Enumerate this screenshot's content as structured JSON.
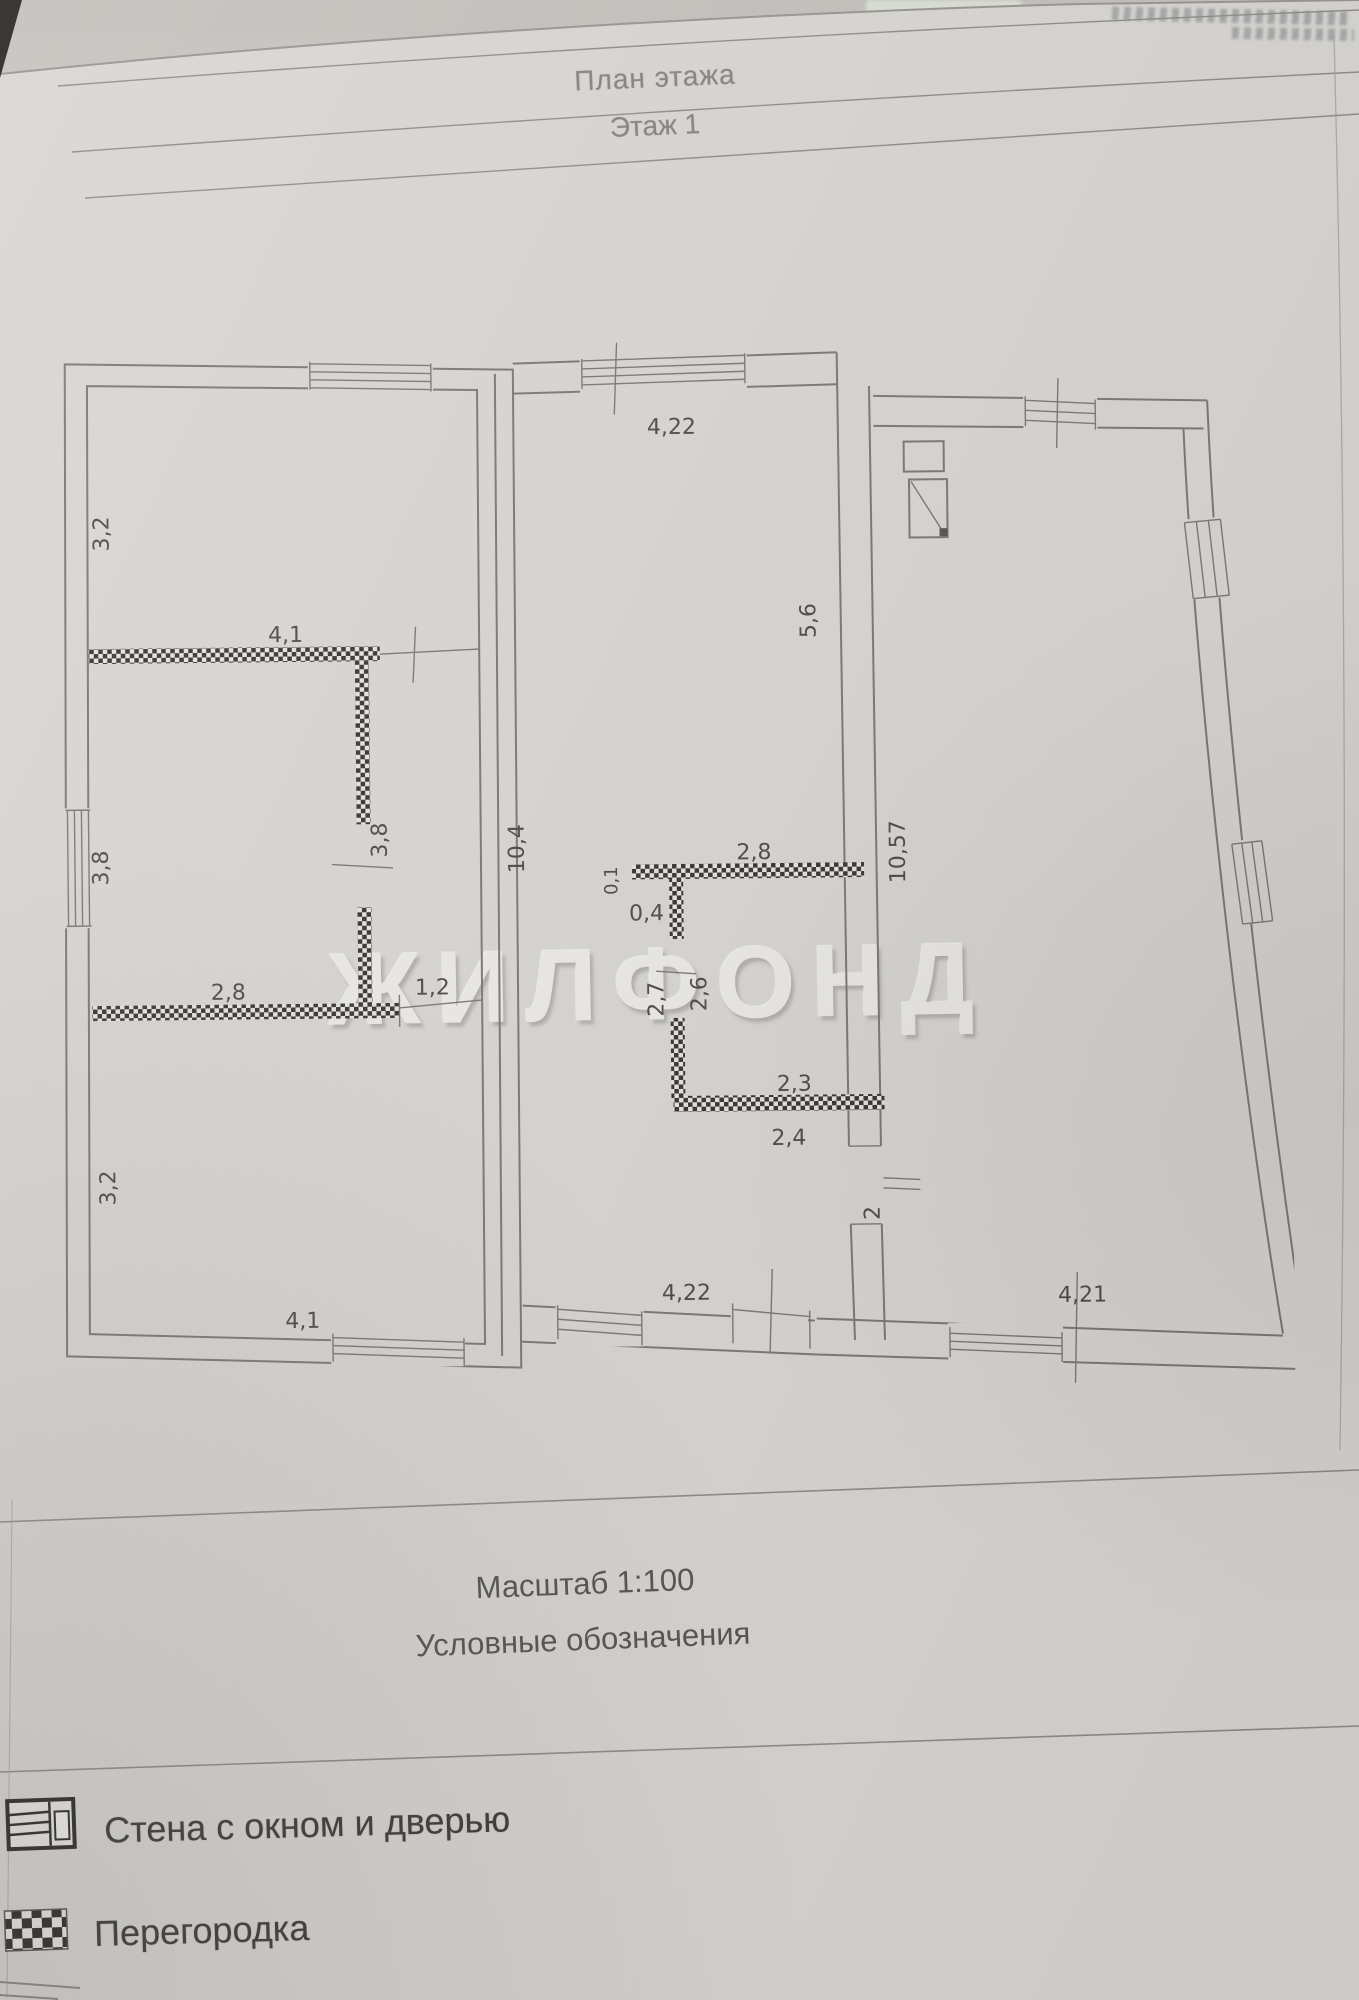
{
  "page": {
    "header": {
      "title": "План этажа",
      "subtitle": "Этаж 1"
    },
    "watermark": "ЖИЛФОНД",
    "footer": {
      "scale_label": "Масштаб 1:100",
      "legend_title": "Условные обозначения"
    }
  },
  "legend": {
    "items": [
      {
        "icon": "wall-window-door-icon",
        "label": "Стена с окном и дверью"
      },
      {
        "icon": "partition-icon",
        "label": "Перегородка"
      }
    ]
  },
  "plan": {
    "labels": {
      "a_top_height": "3,2",
      "a_partition_width": "4,1",
      "a_left_mid_height": "3,8",
      "a_right_mid_height": "3,8",
      "a_lower_partition_width": "2,8",
      "a_door_width": "1,2",
      "a_bottom_height": "3,2",
      "a_bottom_width": "4,1",
      "b_top_width": "4,22",
      "b_left_height": "10,4",
      "bath_offset_small": "0,1",
      "bath_offset": "0,4",
      "bath_top_width": "2,8",
      "bath_left_outer": "2,7",
      "bath_left_inner": "2,6",
      "bath_bottom_inner": "2,3",
      "bath_bottom_outer": "2,4",
      "c_upper_height": "5,6",
      "bc_wall_height": "10,57",
      "bc_door_width": "2",
      "b_bottom_width": "4,22",
      "c_bottom_width": "4,21"
    }
  },
  "colors": {
    "paper": "#d8d6d2",
    "wall_line": "#7b7671",
    "partition_dark": "#35332f",
    "dimension_text": "#4b4845",
    "watermark_text": "#eceae6"
  }
}
